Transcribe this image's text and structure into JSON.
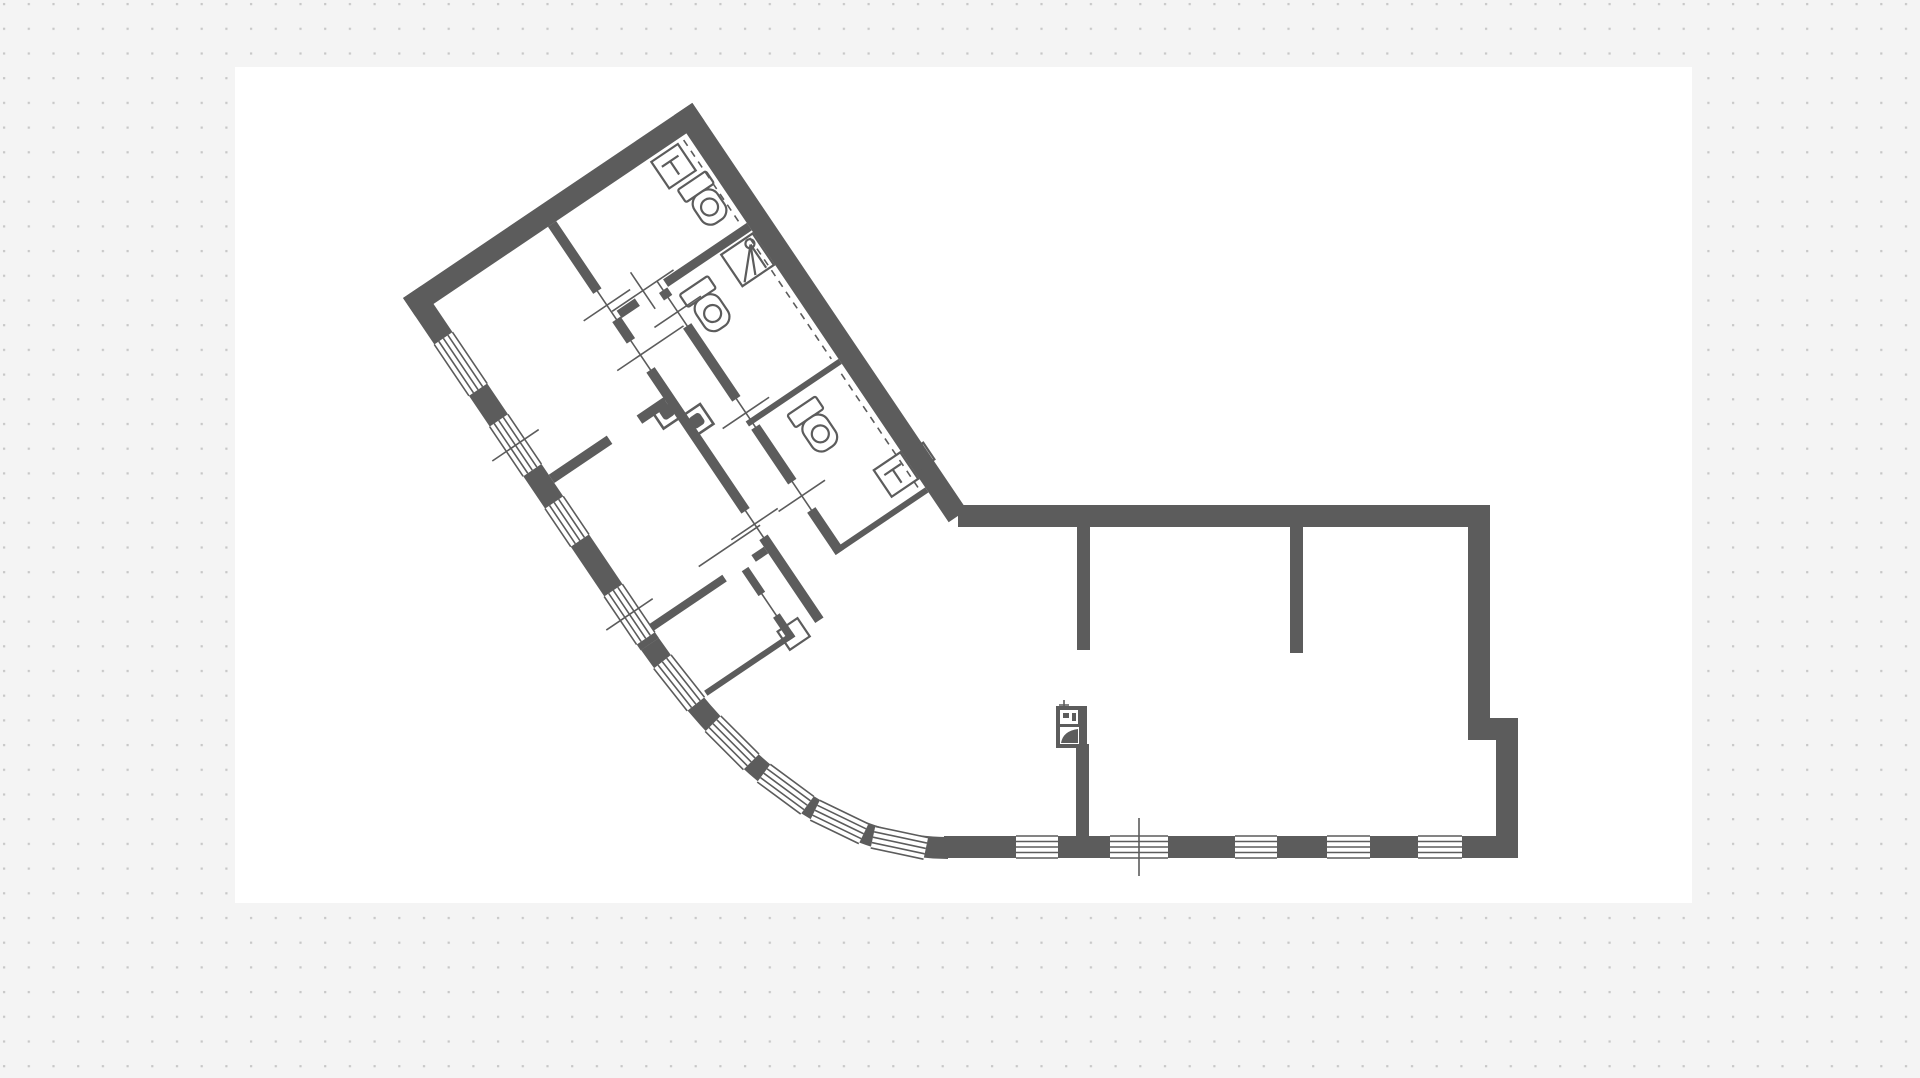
{
  "app": {
    "name": "floor-plan-viewer",
    "view": "plan-canvas"
  },
  "colors": {
    "background": "#f4f4f4",
    "dot": "#c7c7c7",
    "sheet": "#ffffff",
    "wall": "#5c5c5c"
  },
  "grid": {
    "dot_spacing_px": 24.7,
    "dot_size_px": 2.2
  },
  "sheet": {
    "x": 235,
    "y": 67,
    "width": 1457,
    "height": 836
  },
  "floor_plan": {
    "rotated_wing_angle_deg": -34,
    "exterior_wall_thickness_px": 22,
    "rooms": [
      {
        "id": "room-upper-left",
        "type": "room"
      },
      {
        "id": "room-middle-left",
        "type": "room"
      },
      {
        "id": "room-lower-left",
        "type": "room"
      },
      {
        "id": "corridor",
        "type": "circulation"
      },
      {
        "id": "wc-apex",
        "type": "bathroom"
      },
      {
        "id": "wc-middle",
        "type": "bathroom"
      },
      {
        "id": "wc-lower",
        "type": "bathroom"
      },
      {
        "id": "main-hall",
        "type": "open-space"
      }
    ],
    "fixtures": {
      "toilets": 3,
      "sinks": 2,
      "shower_units": 1,
      "utility_boxes": 3
    },
    "windows": {
      "left_wall_segments": 4,
      "curved_wall_segments": 5,
      "bottom_wall_segments": 5
    },
    "door_markers": 8,
    "section_ticks": 3,
    "dashed_guides": 3
  }
}
